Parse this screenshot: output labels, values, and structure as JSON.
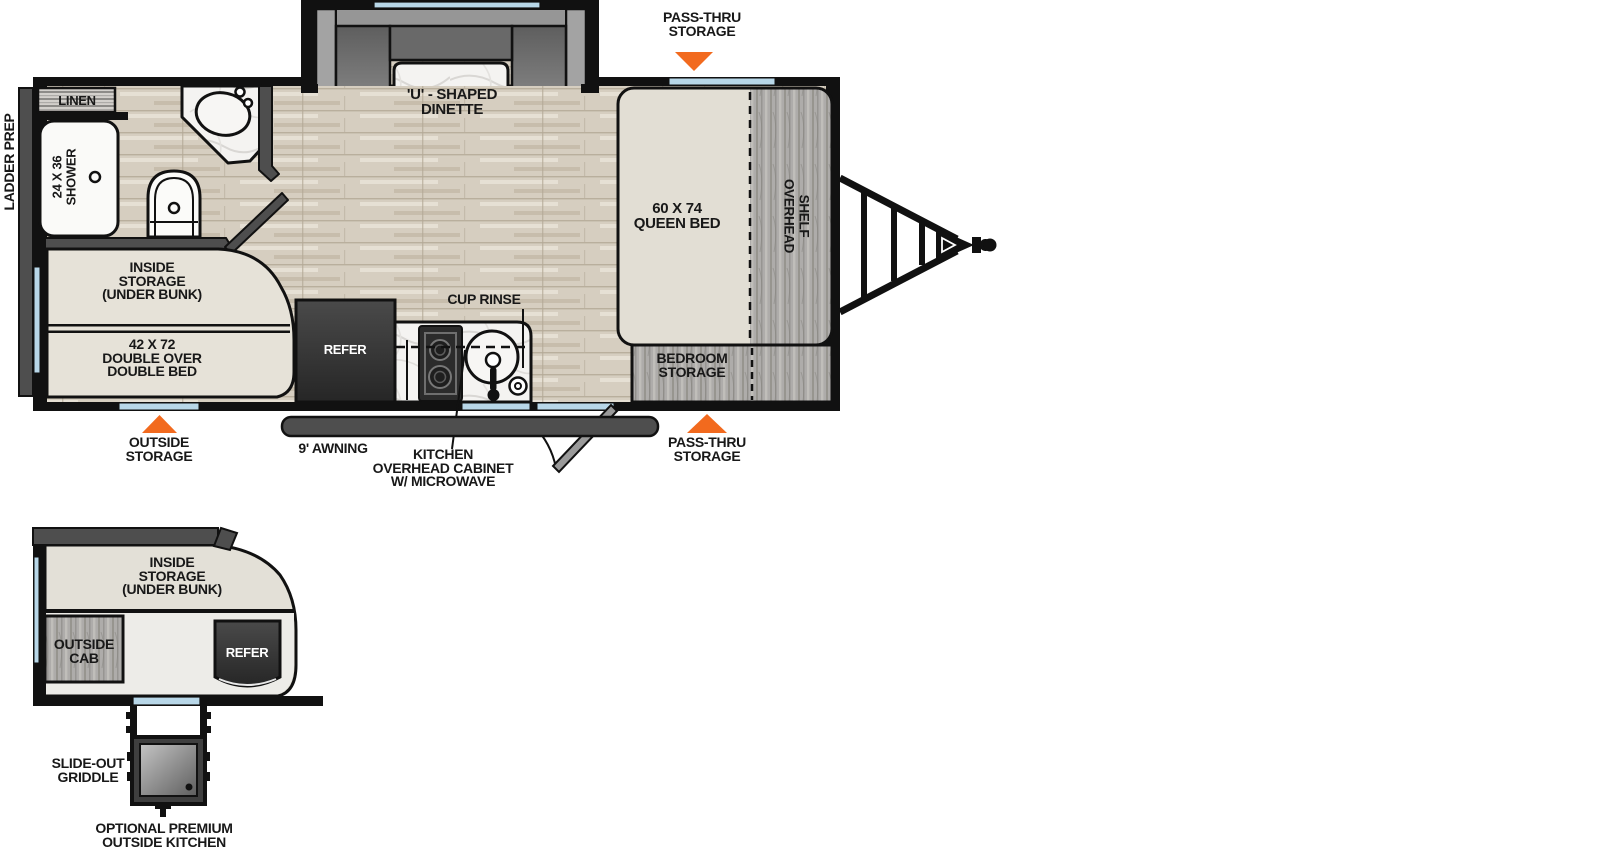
{
  "colors": {
    "wall": "#111111",
    "accent_orange": "#F26A1E",
    "window_blue": "#B8D7E8",
    "floor_wood": "#D6CEC0",
    "bunk_beige": "#E6E2D8",
    "cabinet_gray": "#ADABA8",
    "fixture_dark": "#363636"
  },
  "main": {
    "ladder_prep": "LADDER PREP",
    "pass_thru_top": [
      "PASS-THRU",
      "STORAGE"
    ],
    "dinette": [
      "'U' - SHAPED",
      "DINETTE"
    ],
    "linen": "LINEN",
    "shower": [
      "24 X 36",
      "SHOWER"
    ],
    "queen_bed": [
      "60 X 74",
      "QUEEN BED"
    ],
    "overhead_shelf": [
      "OVERHEAD",
      "SHELF"
    ],
    "inside_storage": [
      "INSIDE",
      "STORAGE",
      "(UNDER BUNK)"
    ],
    "double_bed": [
      "42 X 72",
      "DOUBLE OVER",
      "DOUBLE BED"
    ],
    "refer": "REFER",
    "cup_rinse": "CUP RINSE",
    "bedroom_storage": [
      "BEDROOM",
      "STORAGE"
    ],
    "outside_storage": [
      "OUTSIDE",
      "STORAGE"
    ],
    "awning": "9' AWNING",
    "kitchen_cabinet": [
      "KITCHEN",
      "OVERHEAD CABINET",
      "W/ MICROWAVE"
    ],
    "pass_thru_bottom": [
      "PASS-THRU",
      "STORAGE"
    ]
  },
  "outside_kitchen": {
    "inside_storage": [
      "INSIDE",
      "STORAGE",
      "(UNDER BUNK)"
    ],
    "outside_cab": [
      "OUTSIDE",
      "CAB"
    ],
    "refer": "REFER",
    "slide_out_griddle": [
      "SLIDE-OUT",
      "GRIDDLE"
    ],
    "caption": [
      "OPTIONAL PREMIUM",
      "OUTSIDE KITCHEN"
    ]
  }
}
